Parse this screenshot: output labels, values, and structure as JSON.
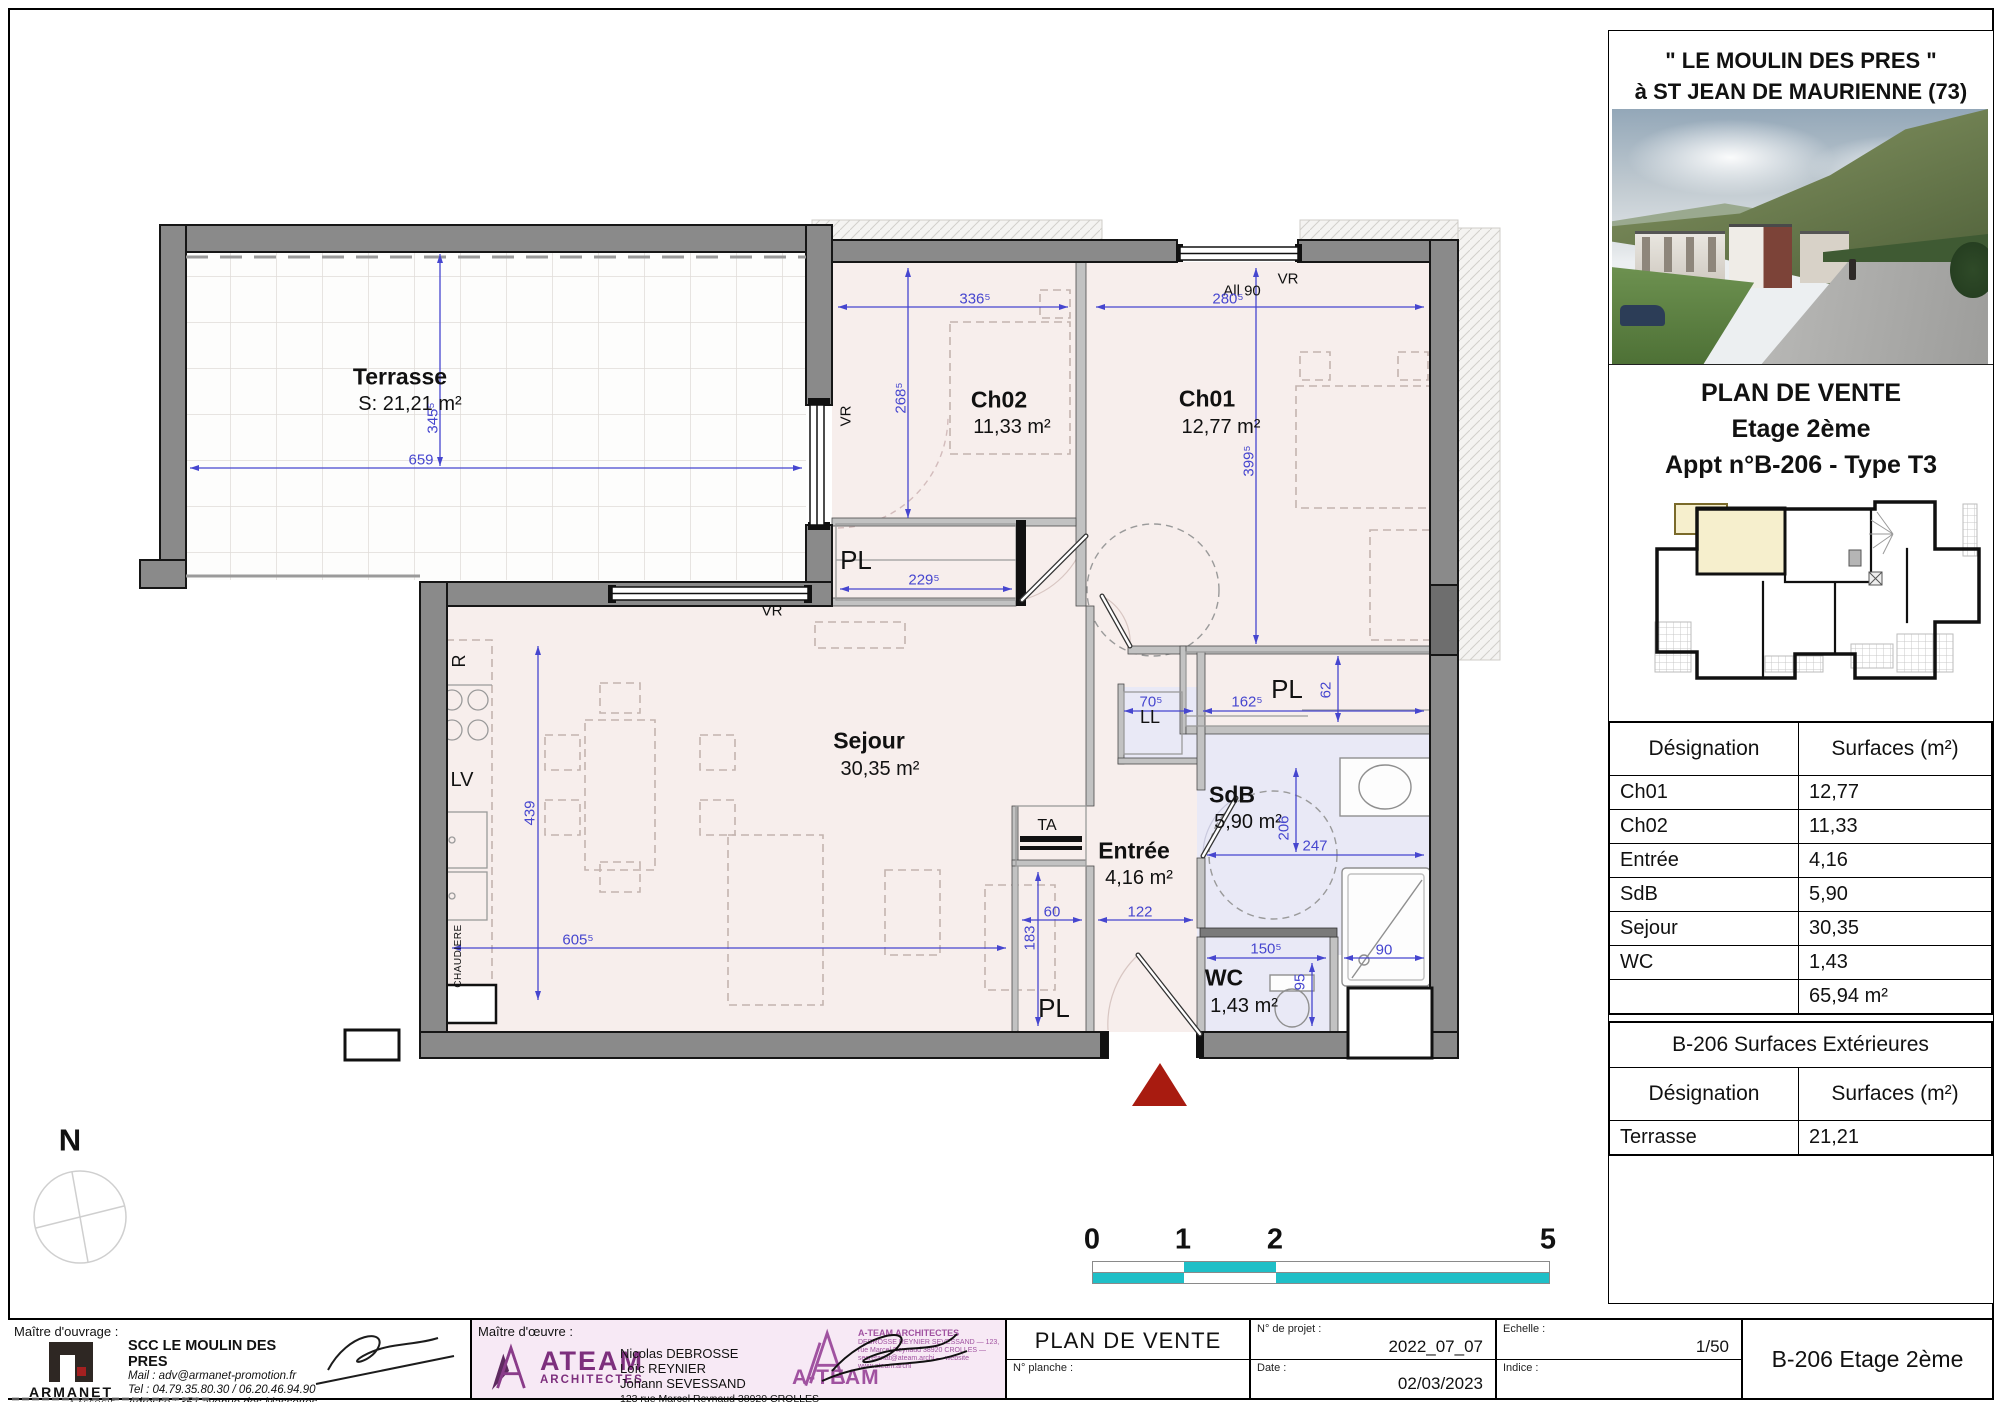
{
  "sheet": {
    "header": {
      "line1": "\" LE MOULIN DES PRES \"",
      "line2": "à ST JEAN DE MAURIENNE (73)"
    },
    "title": {
      "line1": "PLAN DE VENTE",
      "line2": "Etage 2ème",
      "line3": "Appt n°B-206 - Type T3"
    }
  },
  "surfaces": {
    "head": [
      "Désignation",
      "Surfaces (m²)"
    ],
    "rows": [
      [
        "Ch01",
        "12,77"
      ],
      [
        "Ch02",
        "11,33"
      ],
      [
        "Entrée",
        "4,16"
      ],
      [
        "SdB",
        "5,90"
      ],
      [
        "Sejour",
        "30,35"
      ],
      [
        "WC",
        "1,43"
      ]
    ],
    "total": "65,94 m²"
  },
  "exterior": {
    "title": "B-206 Surfaces Extérieures",
    "head": [
      "Désignation",
      "Surfaces (m²)"
    ],
    "rows": [
      [
        "Terrasse",
        "21,21"
      ]
    ]
  },
  "plan": {
    "rooms": {
      "terrasse": {
        "name": "Terrasse",
        "area": "S: 21,21 m²"
      },
      "ch02": {
        "name": "Ch02",
        "area": "11,33 m²"
      },
      "ch01": {
        "name": "Ch01",
        "area": "12,77 m²"
      },
      "sejour": {
        "name": "Sejour",
        "area": "30,35 m²"
      },
      "entree": {
        "name": "Entrée",
        "area": "4,16 m²"
      },
      "sdb": {
        "name": "SdB",
        "area": "5,90 m²"
      },
      "wc": {
        "name": "WC",
        "area": "1,43 m²"
      }
    },
    "labels": {
      "pl": "PL",
      "ll": "LL",
      "ta": "TA",
      "vr": "VR",
      "all90": "All 90",
      "r": "R",
      "lv": "LV",
      "chaudiere": "CHAUDIERE"
    },
    "dims": {
      "d336": "336⁵",
      "d280": "280⁵",
      "d268": "268⁵",
      "d399": "399⁵",
      "d345": "345⁵",
      "d659": "659",
      "d229": "229⁵",
      "d70": "70⁵",
      "d162": "162⁵",
      "d62": "62",
      "d206": "206",
      "d247": "247",
      "d150": "150⁵",
      "d95": "95",
      "d90": "90",
      "d60": "60",
      "d122": "122",
      "d183": "183",
      "d439": "439",
      "d605": "605⁵"
    }
  },
  "scalebar": {
    "n0": "0",
    "n1": "1",
    "n2": "2",
    "n5": "5"
  },
  "compass": {
    "north": "N"
  },
  "footer": {
    "ouvrage": {
      "label": "Maître d'ouvrage :",
      "logo": {
        "name": "ARMANET",
        "sub": "& ASSOCIÉ",
        "tag": "PROMOTEUR CONSTRUCTEUR"
      },
      "company": "SCC LE MOULIN DES PRES",
      "lines": [
        "Mail : adv@armanet-promotion.fr",
        "Tel : 04.79.35.80.30 / 06.20.46.94.90",
        "Adresse : 351 avenue des Massettes",
        "CHALLES-LES-EAUX 73190"
      ],
      "site": "www.armanet-promotion.fr"
    },
    "oeuvre": {
      "label": "Maître d'œuvre :",
      "logo": {
        "name": "ATEAM",
        "sub": "ARCHITECTES"
      },
      "names": [
        "Nicolas DEBROSSE",
        "Loïc REYNIER",
        "Johann SEVESSAND"
      ],
      "address": "123 rue Marcel Reynaud 38920 CROLLES",
      "stamp": {
        "brand": "A-TEAM",
        "line1": "A-TEAM ARCHITECTES",
        "lines": "DEBROSSE REYNIER SEVESSAND — 123, rue Marcel Reynaud 38920 CROLLES — secretariat@ateam.archi — website www.ateam.archi"
      }
    },
    "cartouche": {
      "doc_title": "PLAN DE VENTE",
      "planche_label": "N° planche :",
      "projet_label": "N° de projet :",
      "projet": "2022_07_07",
      "date_label": "Date :",
      "date": "02/03/2023",
      "echelle_label": "Echelle :",
      "echelle": "1/50",
      "indice_label": "Indice :",
      "ref": "B-206 Etage 2ème"
    }
  },
  "colors": {
    "dim_blue": "#4646cf",
    "wall_gray": "#8a8a8a",
    "floor_pink": "#f7eeec",
    "floor_blue": "#e9e9f6",
    "scalebar_teal": "#1fbfc7",
    "entry_red": "#a81b10",
    "keyplan_cream": "#f6efcd",
    "ateam_purple": "#7d2f7d"
  }
}
